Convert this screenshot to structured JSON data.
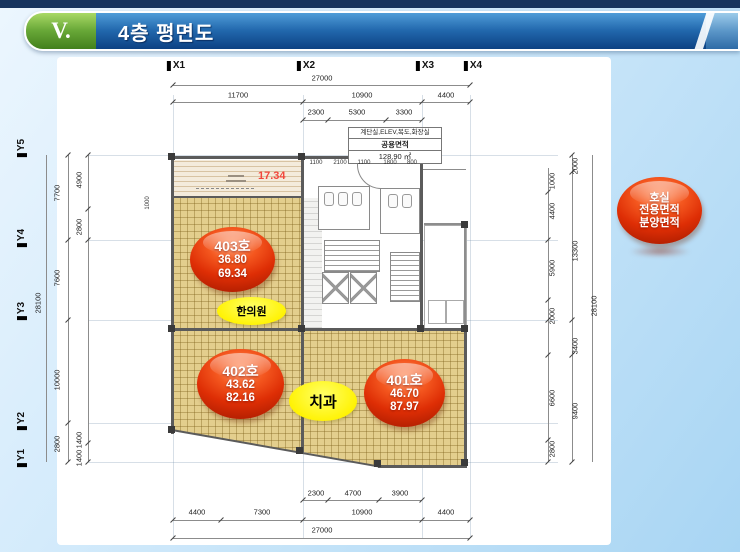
{
  "slide": {
    "section_number": "V.",
    "title": "4층 평면도"
  },
  "legend": {
    "line1": "호실",
    "line2": "전용면적",
    "line3": "분양면적"
  },
  "rooms": {
    "r403": {
      "label": "403호",
      "exclusive": "36.80",
      "sale": "69.34"
    },
    "r402": {
      "label": "402호",
      "exclusive": "43.62",
      "sale": "82.16"
    },
    "r401": {
      "label": "401호",
      "exclusive": "46.70",
      "sale": "87.97"
    }
  },
  "tenants": {
    "hanuiwon": "한의원",
    "chigwa": "치과"
  },
  "annotations": {
    "terrace_area": "17.34"
  },
  "common_table": {
    "row1": "계단실,ELEV,복도,화장실",
    "row2": "공용면적",
    "row3": "128.90 ㎡"
  },
  "grid": {
    "x1": "X1",
    "x2": "X2",
    "x3": "X3",
    "x4": "X4",
    "y1": "Y1",
    "y2": "Y2",
    "y3": "Y3",
    "y4": "Y4",
    "y5": "Y5"
  },
  "dims": {
    "top_total": "27000",
    "top_11700": "11700",
    "top_10900": "10900",
    "top_4400": "4400",
    "top_2300": "2300",
    "top_5300": "5300",
    "top_3300": "3300",
    "core_1100a": "1100",
    "core_2100": "2100",
    "core_1100b": "1100",
    "core_1800": "1800",
    "core_800": "800",
    "bot_2300": "2300",
    "bot_4700": "4700",
    "bot_3900": "3900",
    "bot_4400a": "4400",
    "bot_7300": "7300",
    "bot_10900": "10900",
    "bot_4400b": "4400",
    "bot_total": "27000",
    "left_4900": "4900",
    "left_2800a": "2800",
    "left_1000": "1000",
    "left_7700": "7700",
    "left_7600": "7600",
    "left_10000": "10000",
    "left_2800b": "2800",
    "left_1400a": "1400",
    "left_1400b": "1400",
    "left_total": "28100",
    "right_2000a": "2000",
    "right_1000": "1000",
    "right_4400": "4400",
    "right_13300": "13300",
    "right_5900": "5900",
    "right_2000b": "2000",
    "right_3400": "3400",
    "right_6600": "6600",
    "right_9400": "9400",
    "right_2800": "2800",
    "right_total": "28100"
  }
}
